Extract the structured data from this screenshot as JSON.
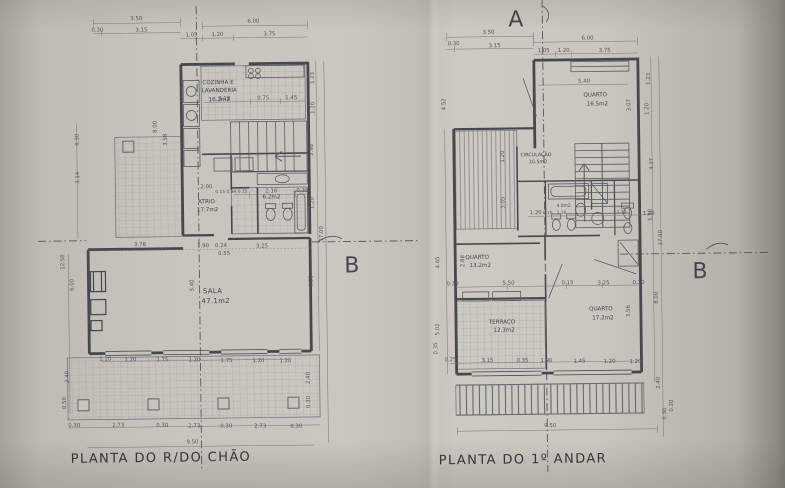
{
  "sheet": {
    "section_a": "A",
    "section_b_left": "B",
    "section_b_right": "B"
  },
  "ground_floor": {
    "title": "PLANTA DO R/DO CHÃO",
    "rooms": {
      "kitchen_line1": "COZINHA E",
      "kitchen_line2": "LAVANDERIA",
      "kitchen_area": "16.2m2",
      "atrium_name": "ATRIO",
      "atrium_area": "17.7m2",
      "wc_area": "6.2m2",
      "living_name": "SALA",
      "living_area": "47.1m2"
    },
    "dims": {
      "top": [
        "3.50",
        "0.30",
        "3.15",
        "6.00",
        "1.05",
        "1.20",
        "3.75"
      ],
      "kitchen_row": [
        "3.18",
        "0.75",
        "1.45"
      ],
      "atrium_row": [
        "0.15 0.84 0.15",
        "2.16",
        "0.35",
        "2.00"
      ],
      "sala_row": [
        "3.78",
        "1.90",
        "0.24",
        "3.25",
        "0.55"
      ],
      "window_row": [
        "1.20",
        "1.20",
        "1.75",
        "1.20",
        "1.75",
        "1.20",
        "1.20"
      ],
      "column_row": [
        "0.30",
        "2.73",
        "0.30",
        "2.73",
        "0.30",
        "2.73",
        "0.30"
      ],
      "total": "9.50",
      "left": [
        "0.30",
        "3.14",
        "8.00",
        "3.58",
        "12.50",
        "6.00",
        "2.40",
        "0.50"
      ],
      "right": [
        "1.23",
        "1.20",
        "3.98",
        "1.20",
        "17.00",
        "6.39",
        "2.40",
        "0.30"
      ],
      "centre": "5.40"
    }
  },
  "first_floor": {
    "title": "PLANTA DO 1º ANDAR",
    "rooms": {
      "bedroom1_name": "QUARTO",
      "bedroom1_area": "16.5m2",
      "circulation_name": "CIRCULAÇÃO",
      "circulation_area": "10.5m2",
      "bath_area": "4.0m2",
      "bedroom2_name": "QUARTO",
      "bedroom2_area": "13.2m2",
      "bedroom3_name": "QUARTO",
      "bedroom3_area": "17.2m2",
      "terrace_name": "TERRAÇO",
      "terrace_area": "12.3m2"
    },
    "dims": {
      "top": [
        "3.50",
        "0.30",
        "3.15",
        "6.00",
        "1.05",
        "1.20",
        "3.75"
      ],
      "bed1_width": "5.40",
      "bath_row": [
        "1.20",
        "0.16",
        "1.26",
        "1.10",
        "1.20"
      ],
      "mid_row": [
        "0.30",
        "5.50",
        "0.15",
        "3.25",
        "0.30"
      ],
      "bottom_row": [
        "0.25",
        "3.15",
        "0.35",
        "1.90",
        "1.45",
        "1.20",
        "1.20"
      ],
      "total": "9.50",
      "left": [
        "4.52",
        "1.20",
        "3.05",
        "4.65",
        "2.88",
        "5.02",
        "0.35"
      ],
      "right": [
        "1.23",
        "1.20",
        "3.07",
        "4.37",
        "1.20",
        "17.00",
        "8.00",
        "3.56",
        "2.40",
        "0.30",
        "0.20"
      ]
    }
  }
}
